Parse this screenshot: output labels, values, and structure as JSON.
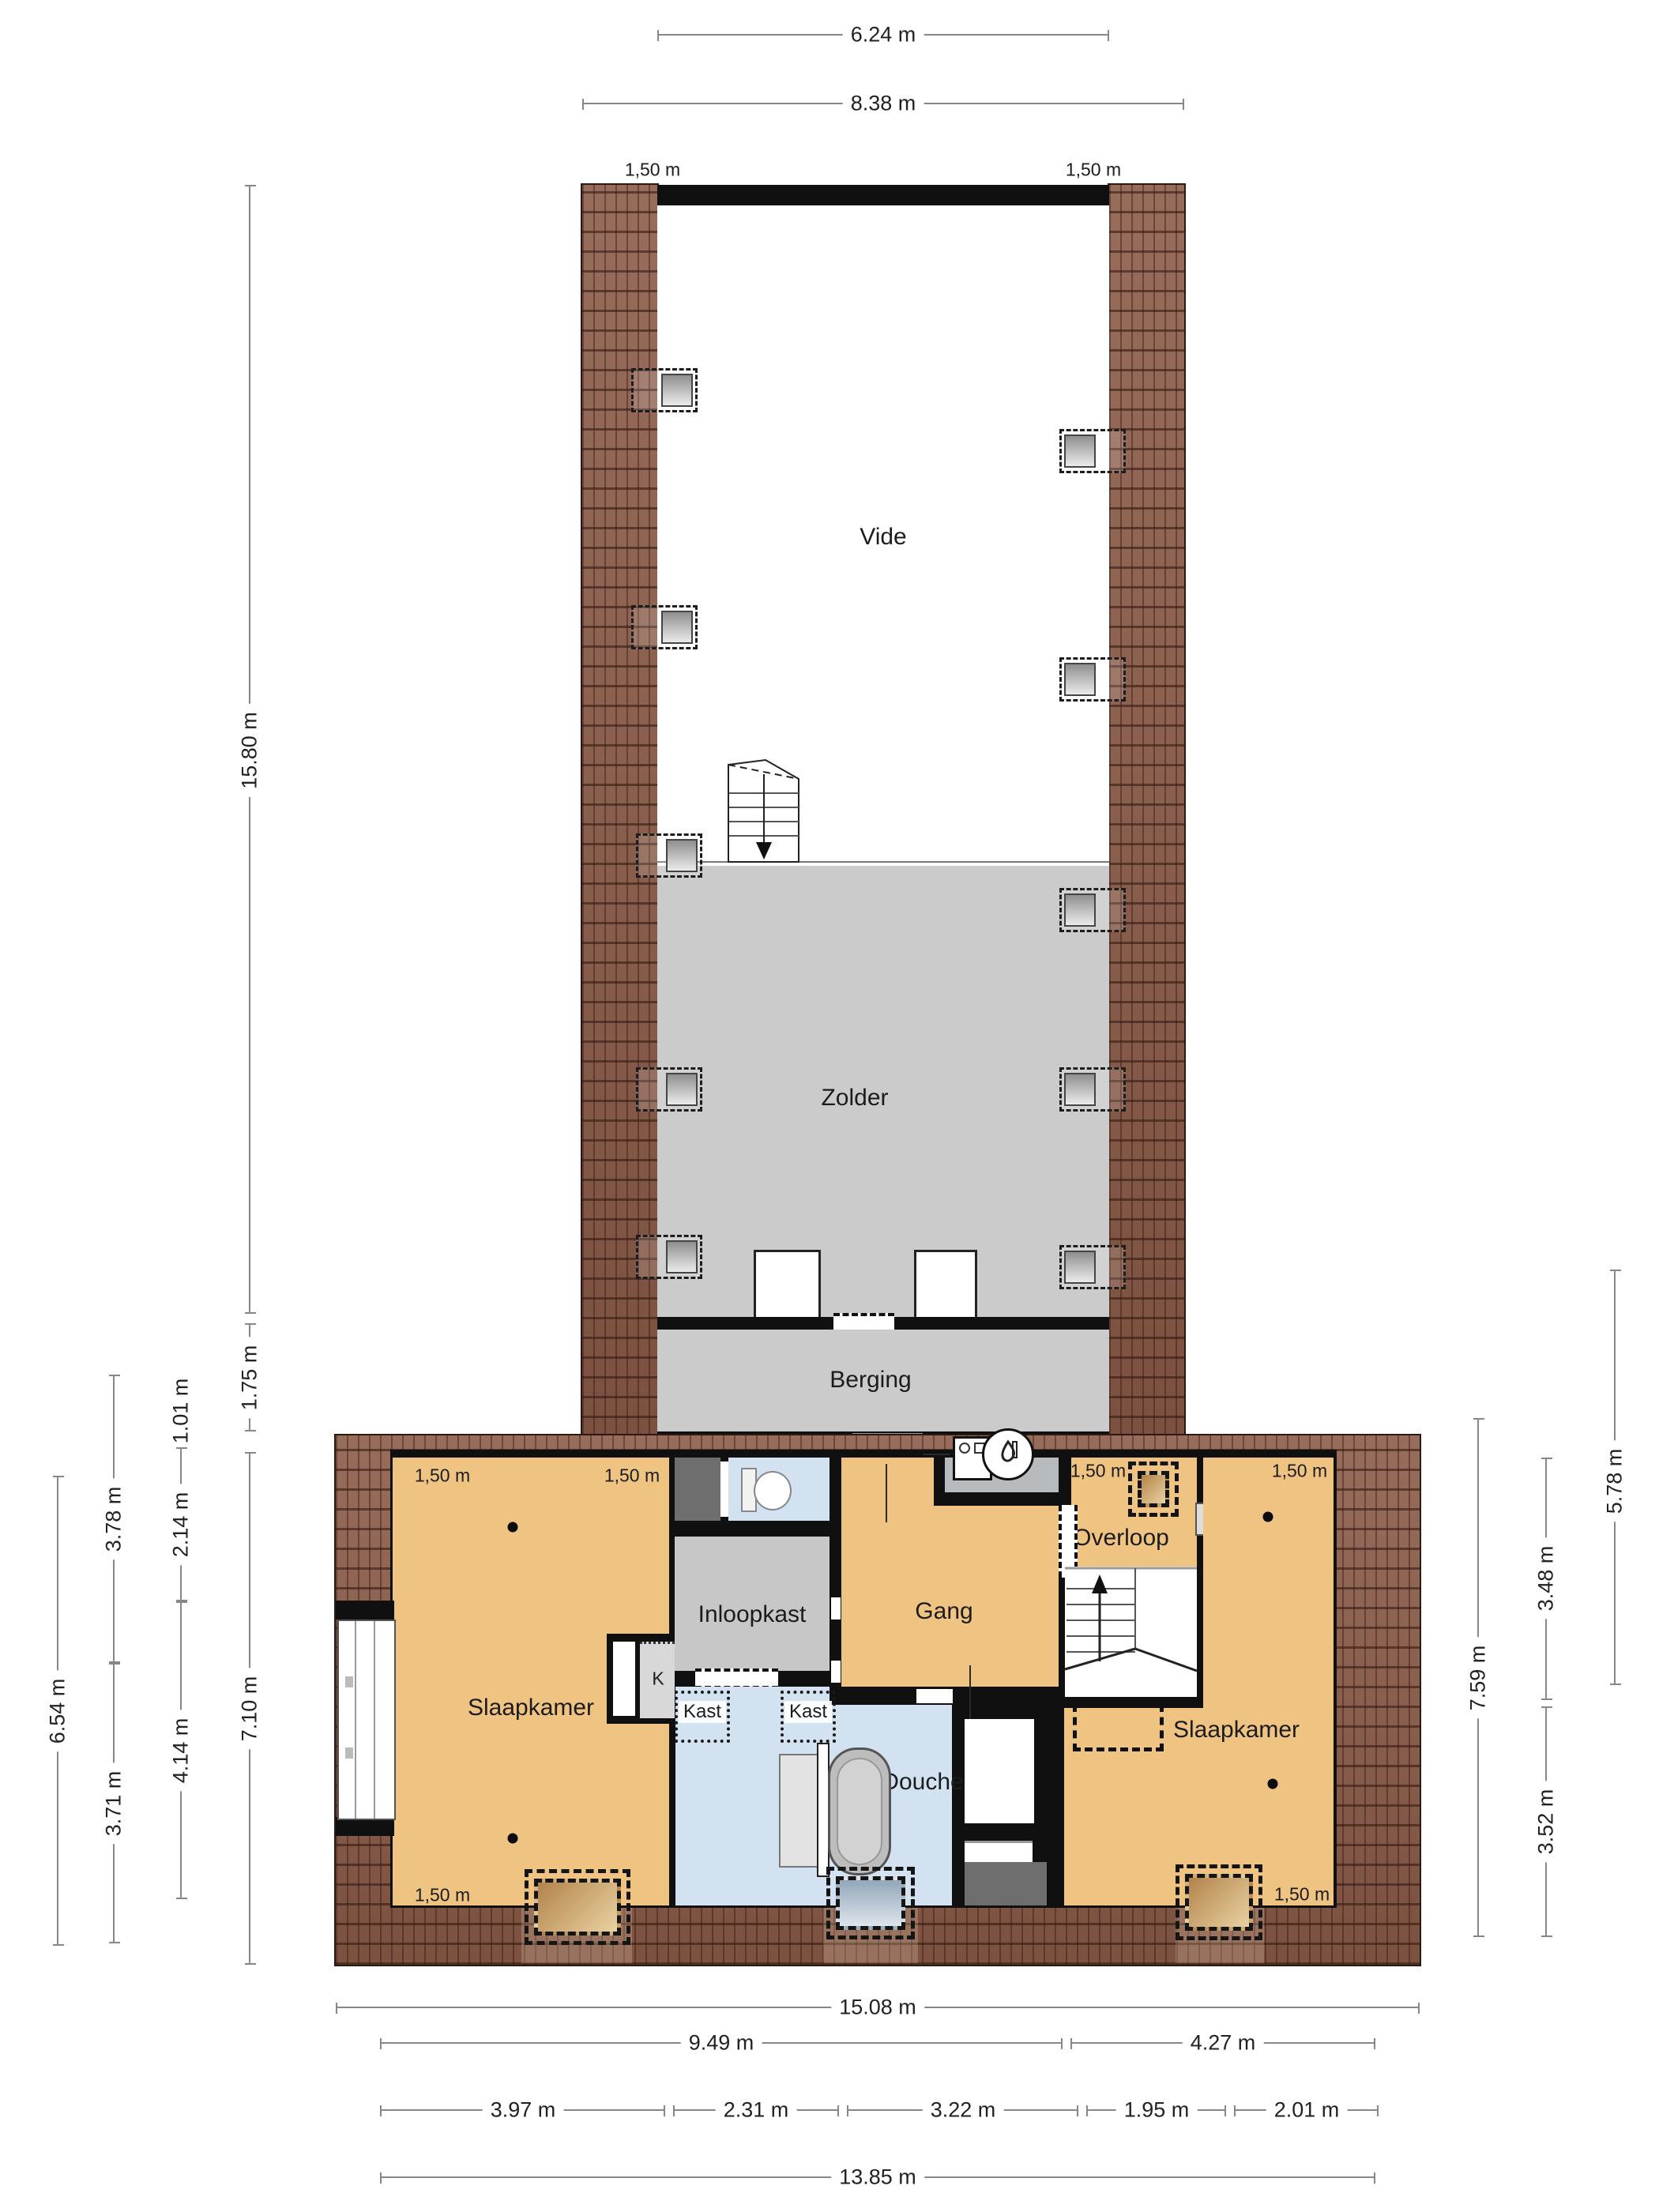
{
  "title": "floorplan-verdieping",
  "colors": {
    "wall": "#101010",
    "brick_roof": "#8d5c49",
    "room_orange": "#efc382",
    "room_gray": "#cbcbcb",
    "room_lightblue": "#d3e2f0",
    "tech_gray": "#b7bbbd",
    "niche_dark": "#6e6e6e",
    "dim_line": "#878787"
  },
  "rooms": {
    "vide": "Vide",
    "zolder": "Zolder",
    "berging": "Berging",
    "slaapkamer_left": "Slaapkamer",
    "inloopkast": "Inloopkast",
    "gang": "Gang",
    "overloop": "Overloop",
    "slaapkamer_right": "Slaapkamer",
    "douche": "Douche",
    "kast_left": "Kast",
    "kast_right": "Kast",
    "k_closet": "K"
  },
  "height_label": "1,50 m",
  "dims": {
    "top_inner": "6.24 m",
    "top_outer": "8.38 m",
    "left_total": "15.80 m",
    "left_berging": "1.75 m",
    "left_block": "7.10 m",
    "left_c1": "6.54 m",
    "left_c2a": "3.78 m",
    "left_c2b": "3.71 m",
    "left_c3a": "1.01 m",
    "left_c3b": "2.14 m",
    "left_c3c": "4.14 m",
    "right_total": "7.59 m",
    "right_a": "3.48 m",
    "right_b": "3.52 m",
    "right_outer": "5.78 m",
    "bottom_total": "15.08 m",
    "bottom_left": "9.49 m",
    "bottom_right": "4.27 m",
    "seg1": "3.97 m",
    "seg2": "2.31 m",
    "seg3": "3.22 m",
    "seg4": "1.95 m",
    "seg5": "2.01 m",
    "bottom_inner": "13.85 m"
  }
}
